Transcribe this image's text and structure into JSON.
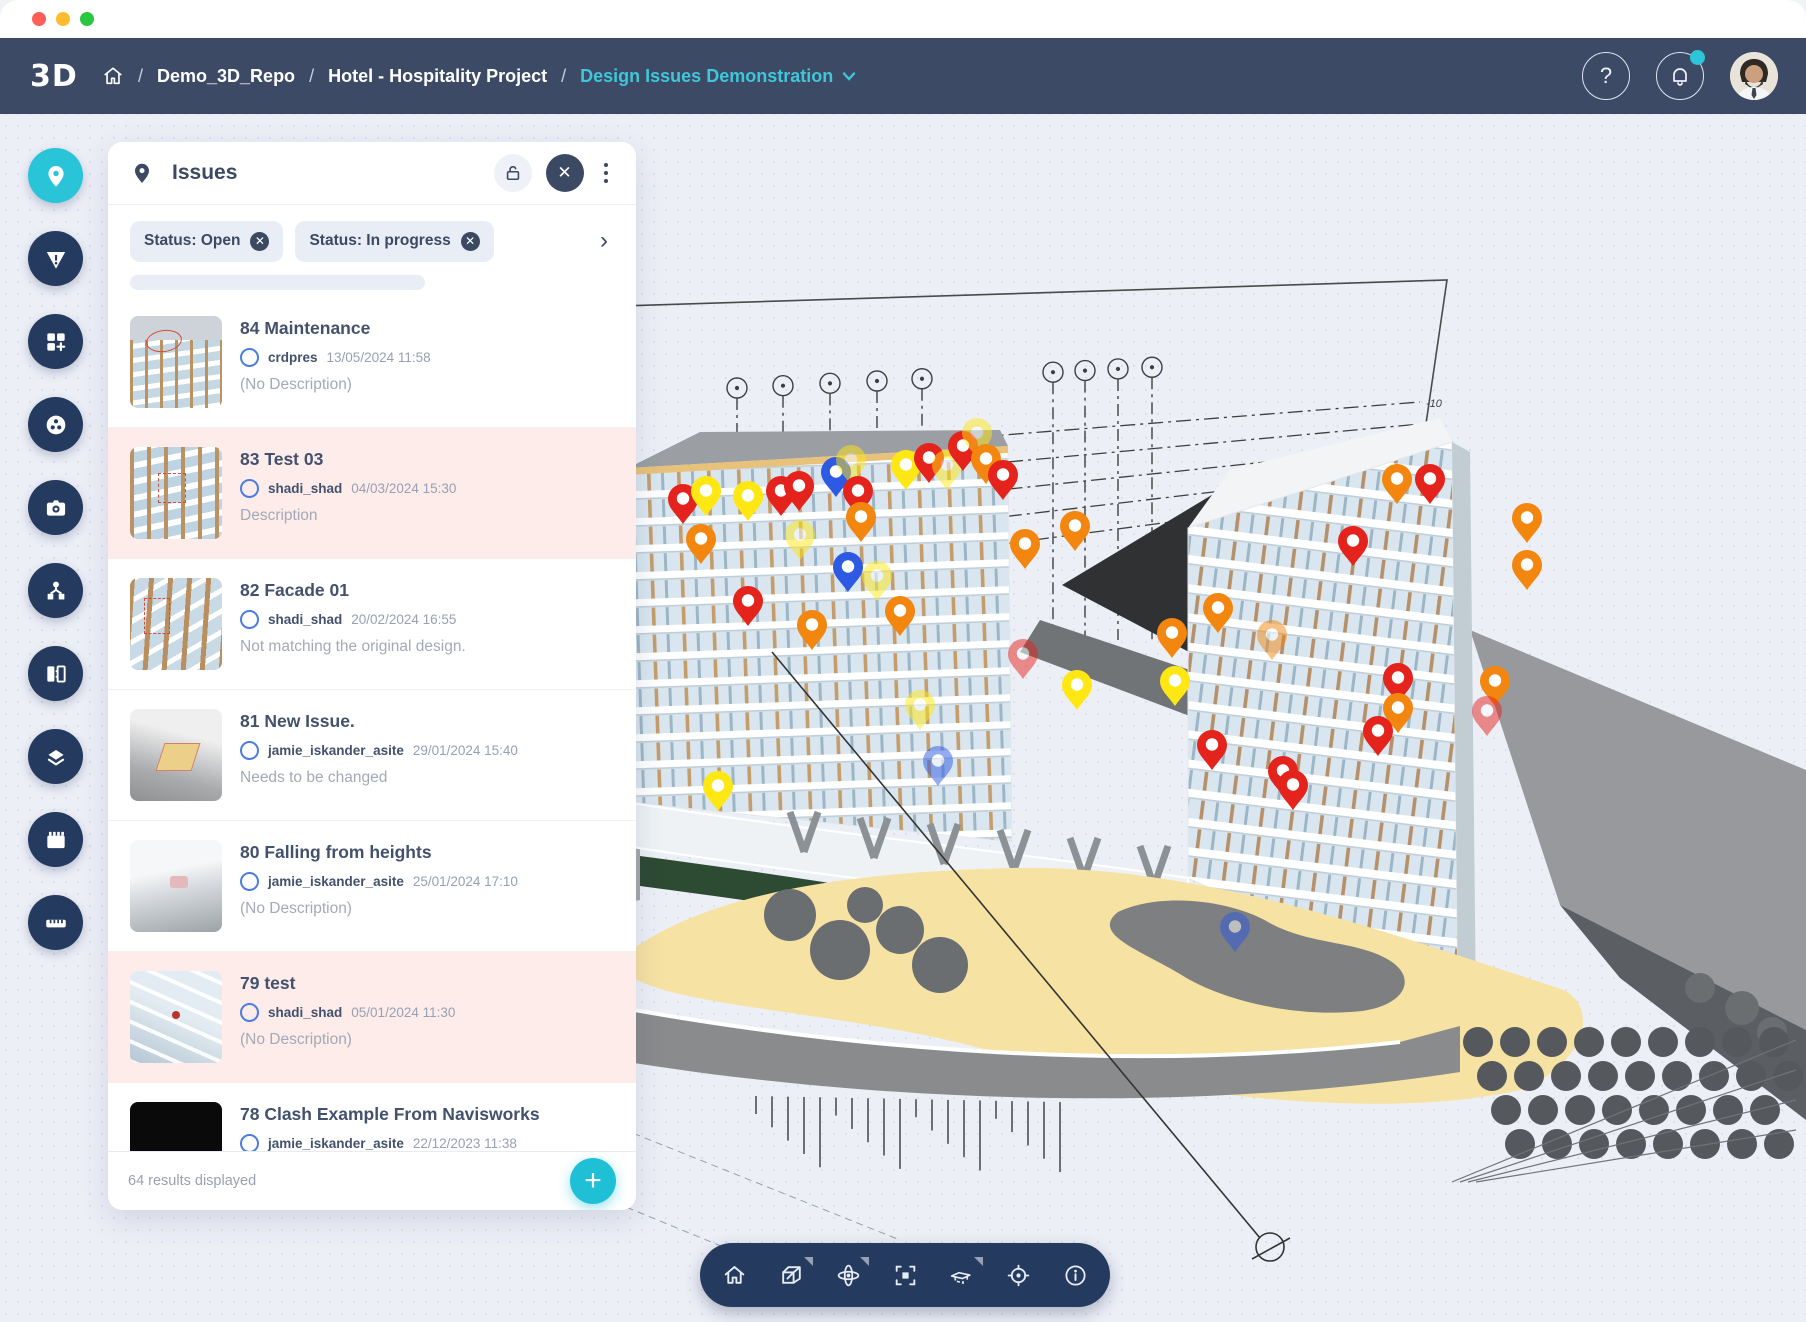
{
  "window": {
    "controls": [
      "close",
      "minimize",
      "maximize"
    ]
  },
  "header": {
    "logo_text": "3D",
    "breadcrumb": {
      "separator": "/",
      "items": [
        "Demo_3D_Repo",
        "Hotel - Hospitality Project"
      ],
      "current": "Design Issues Demonstration"
    },
    "actions": {
      "help_label": "?",
      "notification_has_badge": true
    }
  },
  "sidebar": {
    "items": [
      {
        "id": "issues",
        "icon": "pin-icon",
        "active": true
      },
      {
        "id": "risks",
        "icon": "warning-icon",
        "active": false
      },
      {
        "id": "widgets",
        "icon": "widgets-add-icon",
        "active": false
      },
      {
        "id": "viewpoints",
        "icon": "reel-icon",
        "active": false
      },
      {
        "id": "snapshot",
        "icon": "camera-icon",
        "active": false
      },
      {
        "id": "model-tree",
        "icon": "tree-icon",
        "active": false
      },
      {
        "id": "compare",
        "icon": "compare-icon",
        "active": false
      },
      {
        "id": "layers",
        "icon": "layers-icon",
        "active": false
      },
      {
        "id": "sequences",
        "icon": "filmstrip-icon",
        "active": false
      },
      {
        "id": "measure",
        "icon": "ruler-icon",
        "active": false
      }
    ]
  },
  "issues_panel": {
    "title": "Issues",
    "filters": [
      {
        "label": "Status: Open"
      },
      {
        "label": "Status: In progress"
      }
    ],
    "issues": [
      {
        "title": "84 Maintenance",
        "author": "crdpres",
        "date": "13/05/2024 11:58",
        "description": "(No Description)",
        "selected": false,
        "thumb": "t84"
      },
      {
        "title": "83 Test 03",
        "author": "shadi_shad",
        "date": "04/03/2024 15:30",
        "description": "Description",
        "selected": true,
        "thumb": "t83"
      },
      {
        "title": "82 Facade 01",
        "author": "shadi_shad",
        "date": "20/02/2024 16:55",
        "description": "Not matching the original design.",
        "selected": false,
        "thumb": "t82"
      },
      {
        "title": "81 New Issue.",
        "author": "jamie_iskander_asite",
        "date": "29/01/2024 15:40",
        "description": "Needs to be changed",
        "selected": false,
        "thumb": "t81"
      },
      {
        "title": "80 Falling from heights",
        "author": "jamie_iskander_asite",
        "date": "25/01/2024 17:10",
        "description": "(No Description)",
        "selected": false,
        "thumb": "t80"
      },
      {
        "title": "79 test",
        "author": "shadi_shad",
        "date": "05/01/2024 11:30",
        "description": "(No Description)",
        "selected": true,
        "thumb": "t79"
      },
      {
        "title": "78 Clash Example From Navisworks",
        "author": "jamie_iskander_asite",
        "date": "22/12/2023 11:38",
        "description": "",
        "selected": false,
        "thumb": "t78"
      }
    ],
    "footer": {
      "results_text": "64 results displayed",
      "add_label": "+"
    }
  },
  "viewer": {
    "toolbar": [
      {
        "id": "home",
        "icon": "home-icon",
        "has_menu": false
      },
      {
        "id": "views",
        "icon": "cube-icon",
        "has_menu": true
      },
      {
        "id": "navigation",
        "icon": "orbit-icon",
        "has_menu": true
      },
      {
        "id": "focus",
        "icon": "frame-icon",
        "has_menu": false
      },
      {
        "id": "clip",
        "icon": "clip-icon",
        "has_menu": true
      },
      {
        "id": "coordinates",
        "icon": "target-icon",
        "has_menu": false
      },
      {
        "id": "info",
        "icon": "info-icon",
        "has_menu": false
      }
    ],
    "grid_labels": [
      "-10",
      "-20",
      "-30",
      "-40",
      "-50"
    ],
    "pin_colors": {
      "red": "#e5231d",
      "orange": "#f2860e",
      "yellow": "#ffe713",
      "blue": "#2e59e3"
    },
    "pins": [
      {
        "x": 683,
        "y": 500,
        "c": "red"
      },
      {
        "x": 706,
        "y": 492,
        "c": "yellow"
      },
      {
        "x": 701,
        "y": 540,
        "c": "orange"
      },
      {
        "x": 748,
        "y": 497,
        "c": "yellow"
      },
      {
        "x": 781,
        "y": 492,
        "c": "red"
      },
      {
        "x": 799,
        "y": 487,
        "c": "red"
      },
      {
        "x": 836,
        "y": 473,
        "c": "blue"
      },
      {
        "x": 851,
        "y": 461,
        "c": "yellow",
        "m": true
      },
      {
        "x": 858,
        "y": 492,
        "c": "red"
      },
      {
        "x": 861,
        "y": 518,
        "c": "orange"
      },
      {
        "x": 906,
        "y": 466,
        "c": "yellow"
      },
      {
        "x": 929,
        "y": 459,
        "c": "red"
      },
      {
        "x": 947,
        "y": 466,
        "c": "yellow",
        "m": true
      },
      {
        "x": 963,
        "y": 447,
        "c": "red"
      },
      {
        "x": 977,
        "y": 434,
        "c": "yellow",
        "m": true
      },
      {
        "x": 986,
        "y": 460,
        "c": "orange"
      },
      {
        "x": 1003,
        "y": 476,
        "c": "red"
      },
      {
        "x": 800,
        "y": 536,
        "c": "yellow",
        "m": true
      },
      {
        "x": 848,
        "y": 568,
        "c": "blue"
      },
      {
        "x": 877,
        "y": 577,
        "c": "yellow",
        "m": true
      },
      {
        "x": 748,
        "y": 602,
        "c": "red"
      },
      {
        "x": 812,
        "y": 626,
        "c": "orange"
      },
      {
        "x": 900,
        "y": 612,
        "c": "orange"
      },
      {
        "x": 1023,
        "y": 655,
        "c": "red",
        "m": true
      },
      {
        "x": 1077,
        "y": 686,
        "c": "yellow"
      },
      {
        "x": 920,
        "y": 706,
        "c": "yellow",
        "m": true
      },
      {
        "x": 938,
        "y": 762,
        "c": "blue",
        "m": true
      },
      {
        "x": 718,
        "y": 787,
        "c": "yellow"
      },
      {
        "x": 1025,
        "y": 545,
        "c": "orange"
      },
      {
        "x": 1075,
        "y": 527,
        "c": "orange"
      },
      {
        "x": 1397,
        "y": 480,
        "c": "orange"
      },
      {
        "x": 1430,
        "y": 480,
        "c": "red"
      },
      {
        "x": 1527,
        "y": 519,
        "c": "orange"
      },
      {
        "x": 1527,
        "y": 566,
        "c": "orange"
      },
      {
        "x": 1353,
        "y": 542,
        "c": "red"
      },
      {
        "x": 1218,
        "y": 609,
        "c": "orange"
      },
      {
        "x": 1172,
        "y": 634,
        "c": "orange"
      },
      {
        "x": 1175,
        "y": 682,
        "c": "yellow"
      },
      {
        "x": 1272,
        "y": 636,
        "c": "orange",
        "m": true
      },
      {
        "x": 1398,
        "y": 679,
        "c": "red"
      },
      {
        "x": 1495,
        "y": 682,
        "c": "orange"
      },
      {
        "x": 1487,
        "y": 712,
        "c": "red",
        "m": true
      },
      {
        "x": 1398,
        "y": 709,
        "c": "orange"
      },
      {
        "x": 1378,
        "y": 732,
        "c": "red"
      },
      {
        "x": 1212,
        "y": 746,
        "c": "red"
      },
      {
        "x": 1283,
        "y": 772,
        "c": "red"
      },
      {
        "x": 1293,
        "y": 786,
        "c": "red"
      },
      {
        "x": 1235,
        "y": 928,
        "c": "blue",
        "m": true
      }
    ]
  },
  "colors": {
    "accent_teal": "#29c4d8",
    "header_navy": "#3d4a66",
    "button_navy": "#243a5e",
    "selected_pink": "#fdecea"
  }
}
